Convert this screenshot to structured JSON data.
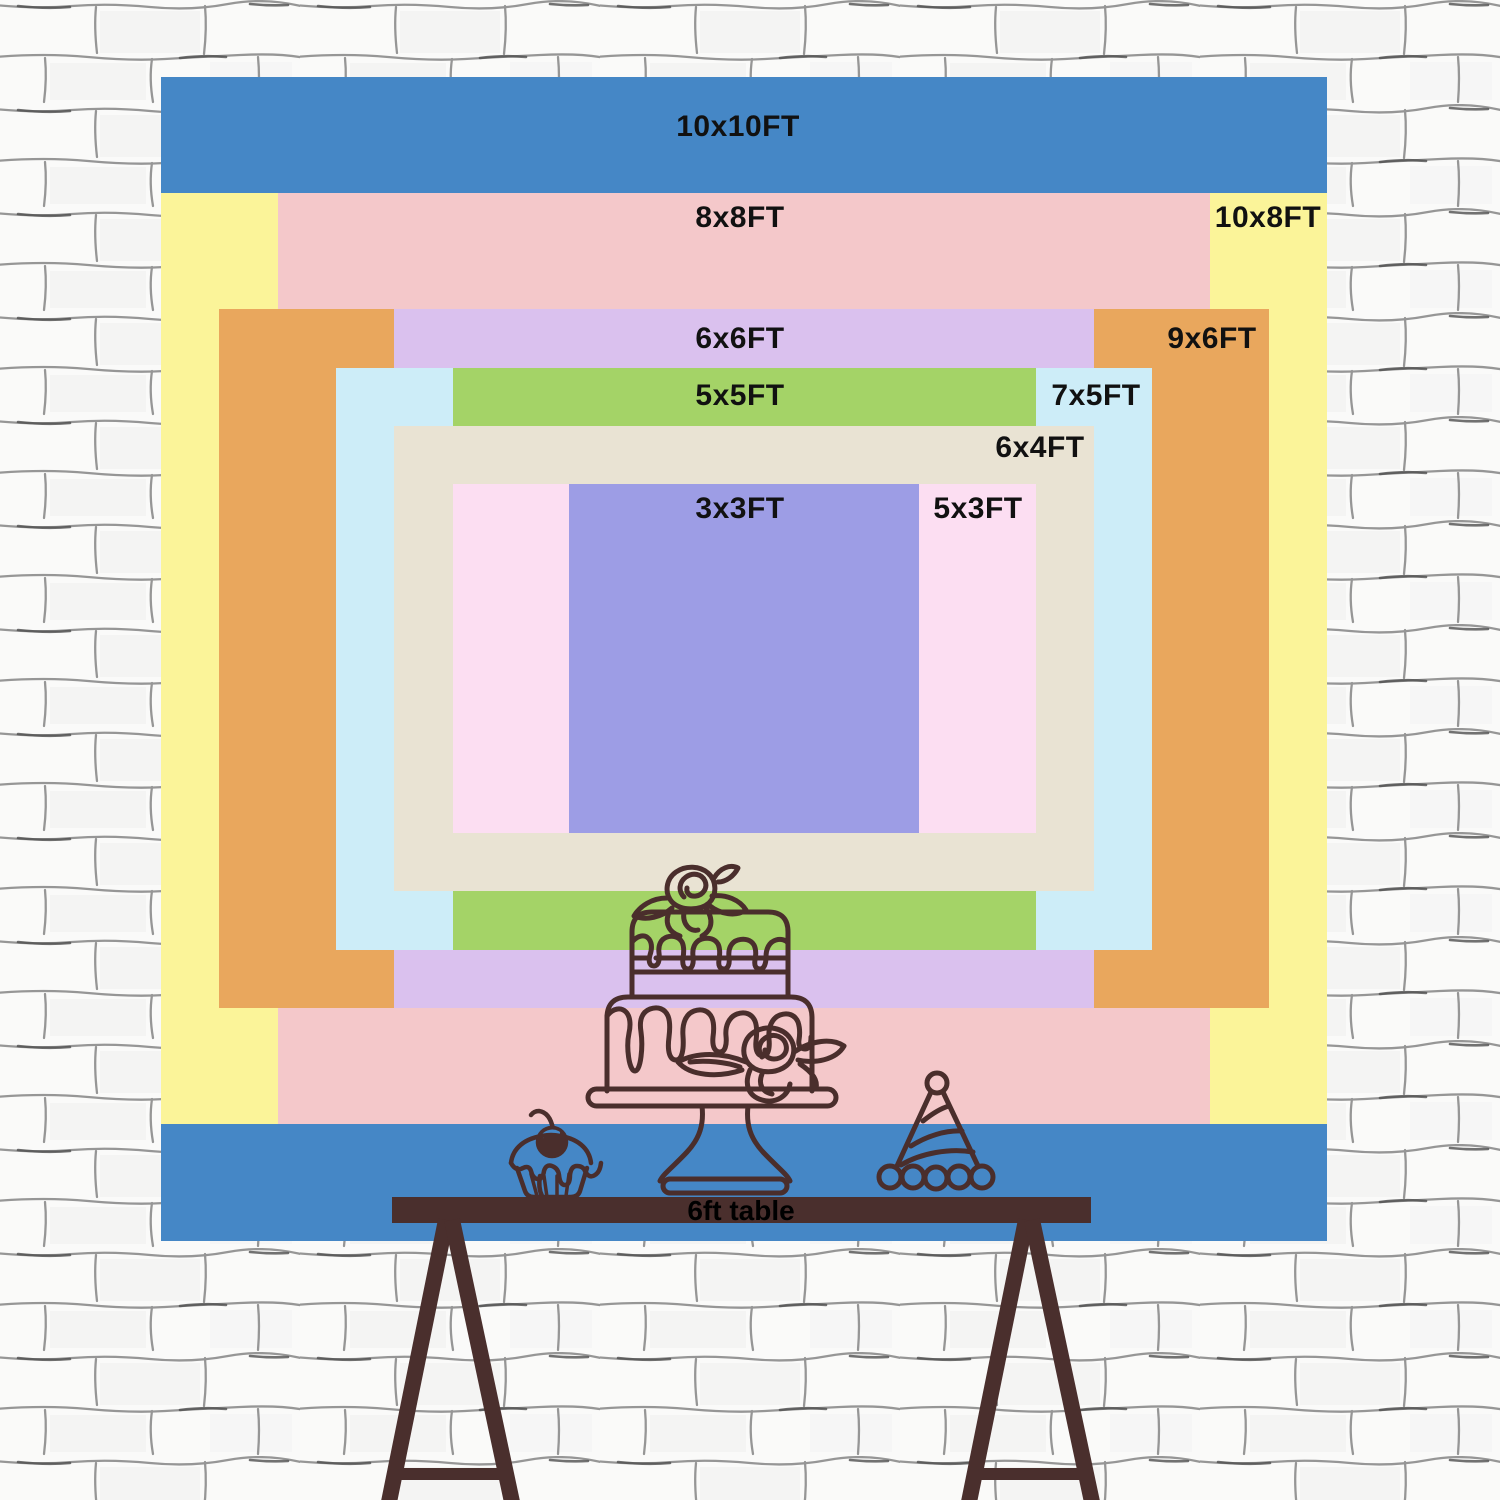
{
  "size_chart": {
    "label_text_color": "#111111",
    "sizes": [
      {
        "id": "10x10ft",
        "label": "10x10FT",
        "width_ft": 10,
        "height_ft": 10,
        "color": "#4587c6",
        "label_x": 738,
        "label_y": 127
      },
      {
        "id": "10x8ft",
        "label": "10x8FT",
        "width_ft": 10,
        "height_ft": 8,
        "color": "#fbf499",
        "label_x": 1268,
        "label_y": 218
      },
      {
        "id": "8x8ft",
        "label": "8x8FT",
        "width_ft": 8,
        "height_ft": 8,
        "color": "#f4c8ca",
        "label_x": 740,
        "label_y": 218
      },
      {
        "id": "9x6ft",
        "label": "9x6FT",
        "width_ft": 9,
        "height_ft": 6,
        "color": "#e9a75d",
        "label_x": 1212,
        "label_y": 339
      },
      {
        "id": "6x6ft",
        "label": "6x6FT",
        "width_ft": 6,
        "height_ft": 6,
        "color": "#dac1ee",
        "label_x": 740,
        "label_y": 339
      },
      {
        "id": "7x5ft",
        "label": "7x5FT",
        "width_ft": 7,
        "height_ft": 5,
        "color": "#cdedf8",
        "label_x": 1096,
        "label_y": 396
      },
      {
        "id": "5x5ft",
        "label": "5x5FT",
        "width_ft": 5,
        "height_ft": 5,
        "color": "#a4d367",
        "label_x": 740,
        "label_y": 396
      },
      {
        "id": "6x4ft",
        "label": "6x4FT",
        "width_ft": 6,
        "height_ft": 4,
        "color": "#e9e3d3",
        "label_x": 1040,
        "label_y": 448
      },
      {
        "id": "5x3ft",
        "label": "5x3FT",
        "width_ft": 5,
        "height_ft": 3,
        "color": "#fcdef2",
        "label_x": 978,
        "label_y": 509
      },
      {
        "id": "3x3ft",
        "label": "3x3FT",
        "width_ft": 3,
        "height_ft": 3,
        "color": "#9d9de5",
        "label_x": 740,
        "label_y": 509
      }
    ]
  },
  "table": {
    "label": "6ft table",
    "label_x": 741,
    "label_y": 1211,
    "label_color": "#000000",
    "wood_color": "#4a2f2d"
  },
  "artwork": {
    "line_color": "#4a2e2c",
    "items": [
      "two-tier-cake-line-art",
      "cupcake-line-art",
      "party-hat-line-art"
    ]
  },
  "wall": {
    "base_color": "#fafaf9",
    "mortar_line_color": "#858585",
    "mortar_dark_line_color": "#4f4f4f"
  }
}
